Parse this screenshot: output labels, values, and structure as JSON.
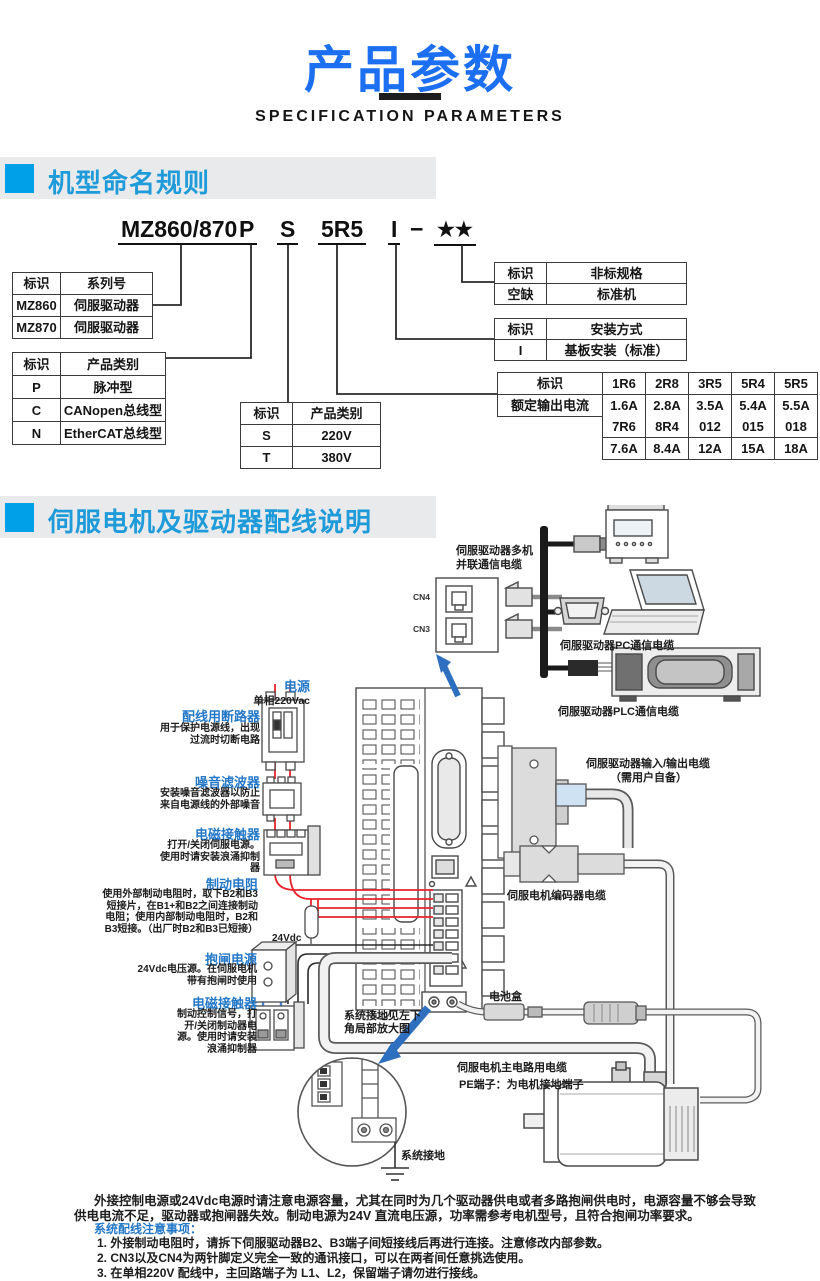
{
  "page": {
    "title": "产品参数",
    "subtitle": "SPECIFICATION PARAMETERS"
  },
  "naming": {
    "heading": "机型命名规则",
    "code": {
      "series": "MZ860/870",
      "type": "P",
      "voltage": "S",
      "current": "5R5",
      "mount": "I",
      "dash": "−",
      "stars": "★★"
    },
    "table_series": {
      "h1": "标识",
      "h2": "系列号",
      "rows": [
        [
          "MZ860",
          "伺服驱动器"
        ],
        [
          "MZ870",
          "伺服驱动器"
        ]
      ]
    },
    "table_type": {
      "h1": "标识",
      "h2": "产品类别",
      "rows": [
        [
          "P",
          "脉冲型"
        ],
        [
          "C",
          "CANopen总线型"
        ],
        [
          "N",
          "EtherCAT总线型"
        ]
      ]
    },
    "table_voltage": {
      "h1": "标识",
      "h2": "产品类别",
      "rows": [
        [
          "S",
          "220V"
        ],
        [
          "T",
          "380V"
        ]
      ]
    },
    "table_nonstd": {
      "h1": "标识",
      "h2": "非标规格",
      "rows": [
        [
          "空缺",
          "标准机"
        ]
      ]
    },
    "table_mount": {
      "h1": "标识",
      "h2": "安装方式",
      "rows": [
        [
          "I",
          "基板安装（标准）"
        ]
      ]
    },
    "table_current": {
      "h": "标识",
      "label": "额定输出电流",
      "codes1": [
        "1R6",
        "2R8",
        "3R5",
        "5R4",
        "5R5"
      ],
      "amps1": [
        "1.6A",
        "2.8A",
        "3.5A",
        "5.4A",
        "5.5A"
      ],
      "codes2": [
        "7R6",
        "8R4",
        "012",
        "015",
        "018"
      ],
      "amps2": [
        "7.6A",
        "8.4A",
        "12A",
        "15A",
        "18A"
      ]
    }
  },
  "wiring": {
    "heading": "伺服电机及驱动器配线说明",
    "labels": {
      "multi1": "伺服驱动器多机",
      "multi2": "并联通信电缆",
      "cn4": "CN4",
      "cn3": "CN3",
      "pc_cable": "伺服驱动器PC通信电缆",
      "plc_cable": "伺服驱动器PLC通信电缆",
      "power": "电源",
      "power_sub": "单相220Vac",
      "breaker": "配线用断路器",
      "breaker_desc": "用于保护电源线，出现过流时切断电路",
      "filter": "噪音滤波器",
      "filter_desc": "安装噪音滤波器以防止来自电源线的外部噪音",
      "contactor1": "电磁接触器",
      "contactor1_desc": "打开/关闭伺服电源。使用时请安装浪涌抑制器",
      "resistor": "制动电阻",
      "resistor_desc": "使用外部制动电阻时，取下B2和B3短接片，在B1+和B2之间连接制动电阻；使用内部制动电阻时，B2和B3短接。（出厂时B2和B3已短接）",
      "v24": "24Vdc",
      "brake_psu": "抱闸电源",
      "brake_psu_desc": "24Vdc电压源。在伺服电机带有抱闸时使用",
      "contactor2": "电磁接触器",
      "contactor2_desc": "制动控制信号，打开/关闭制动器电源。使用时请安装浪涌抑制器",
      "ground_note": "系统接地见左下角局部放大图",
      "battery": "电池盒",
      "io1": "伺服驱动器输入/输出电缆",
      "io2": "（需用户自备）",
      "encoder": "伺服电机编码器电缆",
      "main1": "伺服电机主电路用电缆",
      "main2": "PE端子：为电机接地端子",
      "sys_ground": "系统接地"
    },
    "notes": {
      "para1": "外接控制电源或24Vdc电源时请注意电源容量，尤其在同时为几个驱动器供电或者多路抱闸供电时，电源容量不够会导致",
      "para2": "供电电流不足，驱动器或抱闸器失效。制动电源为24V 直流电压源，功率需参考电机型号，且符合抱闸功率要求。",
      "notes_title": "系统配线注意事项：",
      "item1": "1. 外接制动电阻时，请拆下伺服驱动器B2、B3端子间短接线后再进行连接。注意修改内部参数。",
      "item2": "2. CN3以及CN4为两针脚定义完全一致的通讯接口，可以在两者间任意挑选使用。",
      "item3": "3. 在单相220V 配线中，主回路端子为 L1、L2，保留端子请勿进行接线。",
      "item4": "4. 外接控制电源或24Vdc电源时，请注意区分极性，避免接反导致驱动器损坏。"
    }
  },
  "colors": {
    "accent_blue": "#1d6ff2",
    "section_text_blue": "#1f9bd9",
    "section_square_blue": "#00a0e9",
    "table_header_blue": "#2470c8",
    "wire_red": "#e8232a",
    "arrow_blue": "#2e6fc0"
  }
}
